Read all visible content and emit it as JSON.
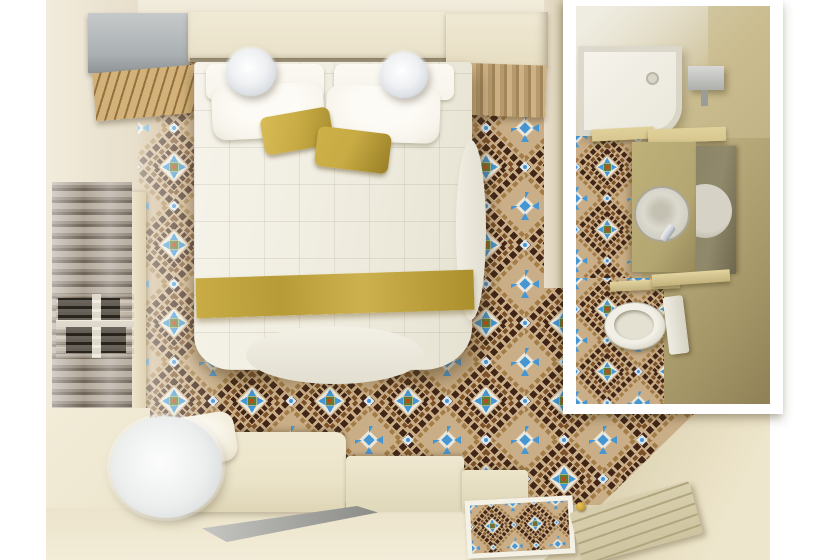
{
  "meta": {
    "description": "Top-down 3D render of a hotel guest room: bedroom with patterned mosaic tile floor, double bed with gold runner, window curtains, daybed and TV console, plus an inset top view of the en-suite bathroom with shower, vanity basin, mirror and toilet.",
    "width": 820,
    "height": 560
  },
  "palette": {
    "canvas_bg": "#ffffff",
    "wall": "#e7decb",
    "wall_dark": "#d9cdae",
    "wall_light": "#f2ecdc",
    "cream": "#f0e9d4",
    "cream_dark": "#ded2b2",
    "gray_box": "#c6c9ca",
    "gray_box_dark": "#8f9597",
    "wood": "#c8a76f",
    "wood_dark": "#96713f",
    "fabric": "#b79a6c",
    "fabric_dark": "#a2855a",
    "bed": "#f3f0e6",
    "pillow": "#f7f4ec",
    "gold": "#c8ab44",
    "gold_dark": "#a68d2f",
    "curtain_a": "#b3a89a",
    "curtain_b": "#8d8275",
    "curtain_c": "#6e6457",
    "window_dark": "#17130e",
    "frame_white": "#f4f1e6",
    "floor_cream": "#ece4cb",
    "floor_cream_light": "#f2ecd8",
    "sofa": "#ece4c9",
    "tv": "#a0a09d",
    "tv_light": "#c6c6c2",
    "door_tan": "#cfc4a0",
    "door_groove": "#b1a67e",
    "knob_gold": "#c3992f",
    "inset_wall": "#cabc8e",
    "inset_wall_dark": "#a99a6e",
    "inset_wall_light": "#efece1",
    "counter": "#d8c78f",
    "cabinet": "#b4a671",
    "mirror": "#90896a",
    "mirror_dark": "#6f684f",
    "porcelain": "#efede3",
    "chrome": "#c9ced4",
    "tile_bg": "#c9ae87",
    "tile_dark": "#412517",
    "tile_mid": "#7b5028",
    "tile_light_brown": "#a37c47",
    "tile_white": "#ebe7db",
    "tile_blue": "#4596d3",
    "tile_green": "#5d7c36",
    "tile_red": "#bf4a1e",
    "tile_ice": "#dfe7ec"
  },
  "objects": {
    "room": {
      "label": "Hotel bedroom, top-down 3D render"
    },
    "inset": {
      "label": "En-suite bathroom, top-down inset"
    },
    "floor": {
      "label": "Patterned mosaic tile floor"
    },
    "bed": {
      "label": "Double bed with white quilted duvet"
    },
    "runner": {
      "label": "Gold bed runner"
    },
    "pillow_white": {
      "label": "White pillow"
    },
    "pillow_gold": {
      "label": "Gold accent pillow"
    },
    "lamp": {
      "label": "Fluffy sphere pendant lamp"
    },
    "wardrobe_gray": {
      "label": "Grey wardrobe unit"
    },
    "headboard": {
      "label": "Cream headboard shelf"
    },
    "wardrobe_cream": {
      "label": "Cream closet unit"
    },
    "bench_wood": {
      "label": "Slatted wood luggage bench"
    },
    "bench_fabric": {
      "label": "Draped fabric bench"
    },
    "curtains": {
      "label": "Floor-length curtains"
    },
    "window": {
      "label": "Window behind curtains"
    },
    "rug": {
      "label": "White fluffy round rug"
    },
    "sofa": {
      "label": "Cream daybed with cushion"
    },
    "console": {
      "label": "Low cream console"
    },
    "tv": {
      "label": "Flat screen on console"
    },
    "doormat": {
      "label": "Tiled doormat inset"
    },
    "door": {
      "label": "Entrance door"
    },
    "entry_wall": {
      "label": "Entry corner wall"
    },
    "shower": {
      "label": "Walk-in shower tray"
    },
    "drain": {
      "label": "Shower drain"
    },
    "sconce": {
      "label": "Bathroom wall light"
    },
    "vanity": {
      "label": "Vanity cabinet"
    },
    "counter": {
      "label": "Vanity counter"
    },
    "basin": {
      "label": "Round basin with faucet"
    },
    "mirror": {
      "label": "Vanity mirror"
    },
    "shelf": {
      "label": "Shelf above toilet"
    },
    "toilet": {
      "label": "Toilet"
    }
  }
}
